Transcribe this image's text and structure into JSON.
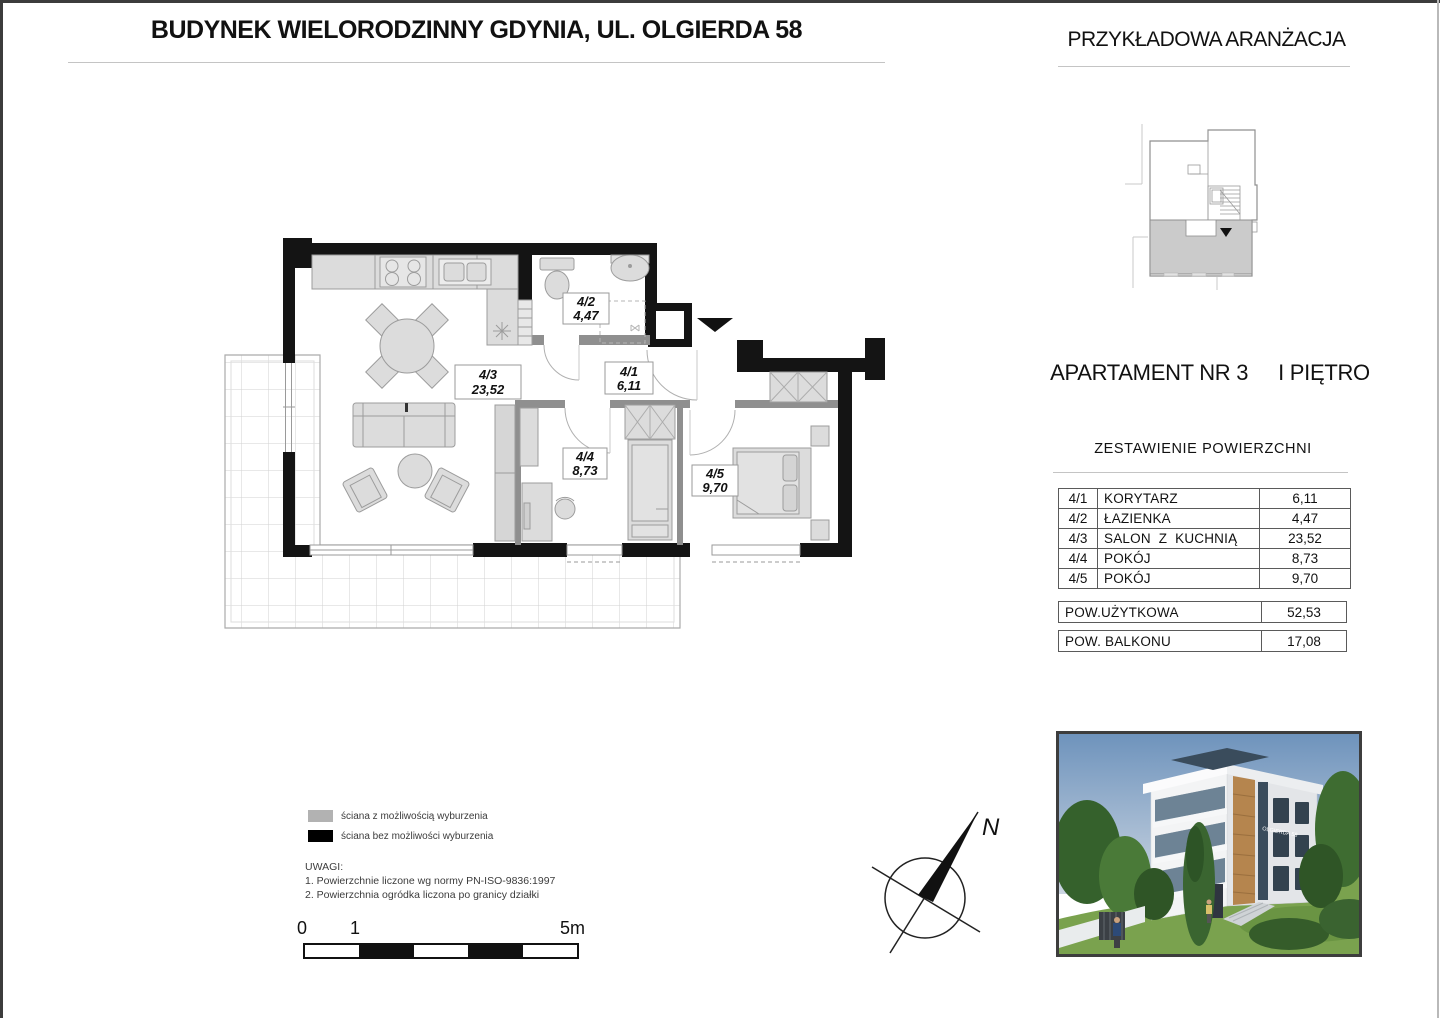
{
  "header": {
    "title": "BUDYNEK WIELORODZINNY GDYNIA, UL. OLGIERDA 58"
  },
  "right_panel": {
    "heading": "PRZYKŁADOWA ARANŻACJA",
    "apartment_title": "APARTAMENT NR 3",
    "apartment_floor": "I PIĘTRO",
    "areas_heading": "ZESTAWIENIE POWIERZCHNI",
    "rows": [
      {
        "code": "4/1",
        "name": "KORYTARZ",
        "area": "6,11"
      },
      {
        "code": "4/2",
        "name": "ŁAZIENKA",
        "area": "4,47"
      },
      {
        "code": "4/3",
        "name": "SALON Z KUCHNIĄ",
        "area": "23,52"
      },
      {
        "code": "4/4",
        "name": "POKÓJ",
        "area": "8,73"
      },
      {
        "code": "4/5",
        "name": "POKÓJ",
        "area": "9,70"
      }
    ],
    "usable": {
      "label": "POW.UŻYTKOWA",
      "value": "52,53"
    },
    "balcony": {
      "label": "POW. BALKONU",
      "value": "17,08"
    }
  },
  "plan": {
    "rooms": [
      {
        "code": "4/1",
        "area": "6,11"
      },
      {
        "code": "4/2",
        "area": "4,47"
      },
      {
        "code": "4/3",
        "area": "23,52"
      },
      {
        "code": "4/4",
        "area": "8,73"
      },
      {
        "code": "4/5",
        "area": "9,70"
      }
    ]
  },
  "legend": {
    "items": [
      {
        "label": "ściana z możliwością wyburzenia",
        "color": "#b2b2b2"
      },
      {
        "label": "ściana bez możliwości wyburzenia",
        "color": "#000000"
      }
    ],
    "notes_title": "UWAGI:",
    "notes": [
      "1. Powierzchnie liczone wg normy PN-ISO-9836:1997",
      "2. Powierzchnia ogródka liczona po granicy działki"
    ]
  },
  "scalebar": {
    "tick0": "0",
    "tick1": "1",
    "tick5": "5m"
  },
  "compass": {
    "north": "N"
  },
  "photo": {
    "sign": "OLGIERDA 58"
  }
}
